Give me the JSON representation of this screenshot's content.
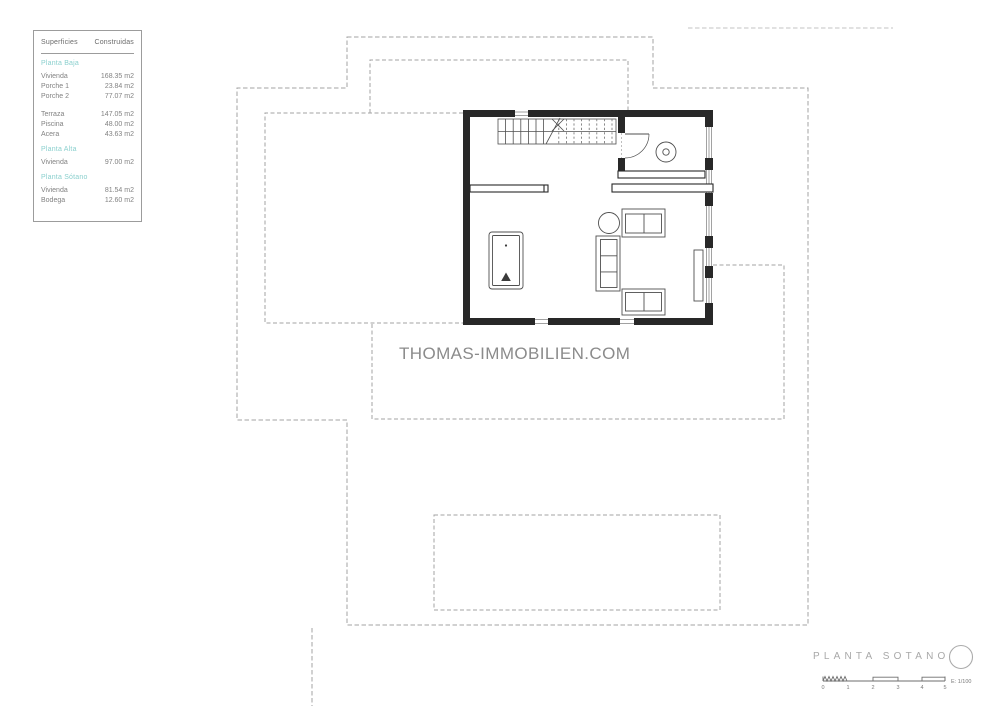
{
  "legend": {
    "header": {
      "col1": "Superficies",
      "col2": "Construidas"
    },
    "groups": [
      {
        "title": "Planta Baja",
        "items": [
          {
            "label": "Vivienda",
            "value": "168.35 m2"
          },
          {
            "label": "Porche 1",
            "value": "23.84 m2"
          },
          {
            "label": "Porche 2",
            "value": "77.07 m2"
          }
        ]
      },
      {
        "title": "",
        "items": [
          {
            "label": "Terraza",
            "value": "147.05 m2"
          },
          {
            "label": "Piscina",
            "value": "48.00 m2"
          },
          {
            "label": "Acera",
            "value": "43.63 m2"
          }
        ]
      },
      {
        "title": "Planta Alta",
        "items": [
          {
            "label": "Vivienda",
            "value": "97.00 m2"
          }
        ]
      },
      {
        "title": "Planta Sótano",
        "items": [
          {
            "label": "Vivienda",
            "value": "81.54 m2"
          },
          {
            "label": "Bodega",
            "value": "12.60 m2"
          }
        ]
      }
    ]
  },
  "watermark": "THOMAS-IMMOBILIEN.COM",
  "titleblock": {
    "title": "PLANTA SOTANO",
    "scale_label": "E: 1/100",
    "ticks": [
      "0",
      "1",
      "2",
      "3",
      "4",
      "5"
    ]
  },
  "colors": {
    "accent_teal": "#8bd0ce",
    "wall_dark": "#282828",
    "line_medium": "#4f4f4f",
    "dashed_gray": "#a3a3a3",
    "text_gray": "#828282",
    "watermark_gray": "#8b8b8b",
    "title_gray": "#a8a8a8"
  }
}
